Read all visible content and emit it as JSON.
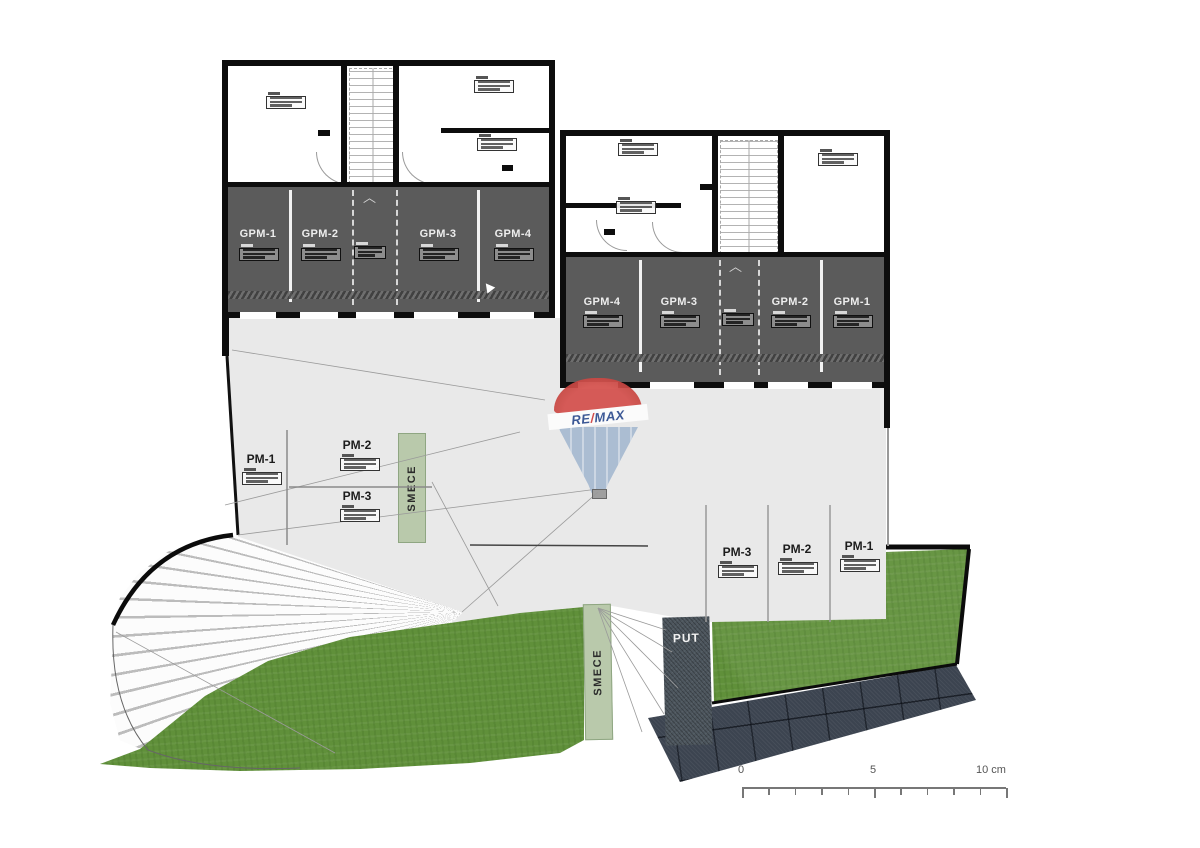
{
  "plan": {
    "left_building": {
      "stalls": [
        "GPM-1",
        "GPM-2",
        "GPM-3",
        "GPM-4"
      ]
    },
    "right_building": {
      "stalls": [
        "GPM-4",
        "GPM-3",
        "GPM-2",
        "GPM-1"
      ]
    },
    "left_parking": {
      "stalls": [
        "PM-1",
        "PM-2",
        "PM-3"
      ]
    },
    "right_parking": {
      "stalls": [
        "PM-3",
        "PM-2",
        "PM-1"
      ]
    },
    "labels": {
      "smece": "SMECE",
      "put": "PUT"
    },
    "logo": {
      "re": "RE",
      "slash": "/",
      "max": "MAX"
    },
    "scale": {
      "start": "0",
      "mid": "5",
      "end": "10 cm"
    },
    "colors": {
      "grass": "#60903a",
      "garage": "#5b5b5b",
      "driveway": "#e9e9e9",
      "stone": "#3c4450",
      "put_strip": "#4d565e",
      "smece_strip": "#b9c9ab",
      "logo_red": "#c8403c",
      "logo_blue": "#2e4d8f",
      "balloon_blue": "#a7bad1"
    }
  }
}
